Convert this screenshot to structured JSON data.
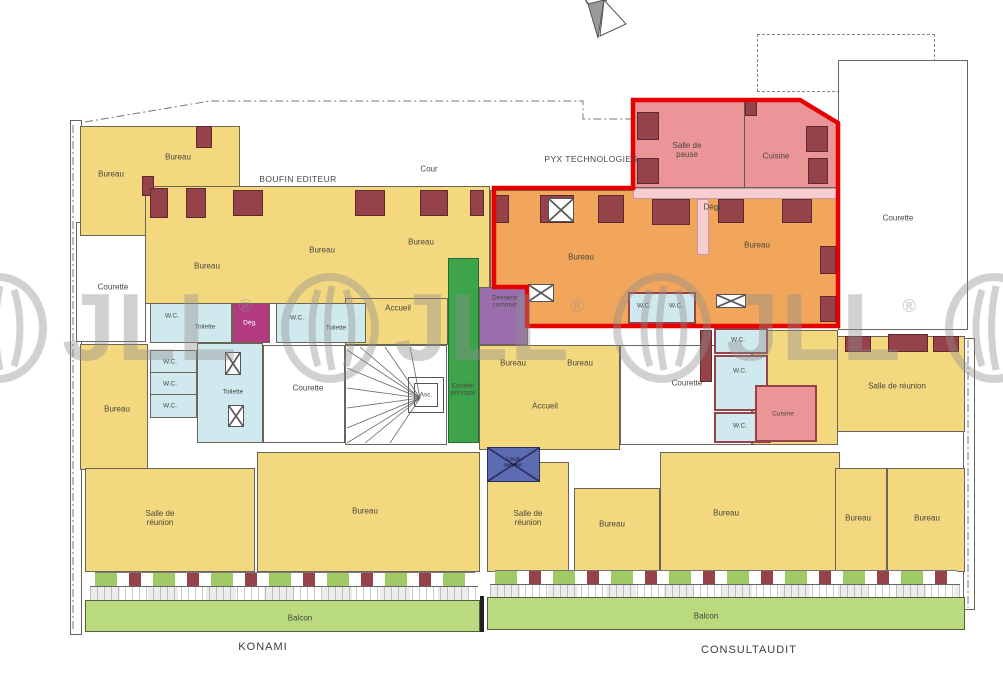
{
  "document": {
    "type": "architectural-floor-plan"
  },
  "companies": {
    "boufin": "BOUFIN EDITEUR",
    "pyx": "PYX TECHNOLOGIES",
    "konami": "KONAMI",
    "consultaudit": "CONSULTAUDIT"
  },
  "rooms": {
    "bureau": "Bureau",
    "cour": "Cour",
    "courette": "Courette",
    "salle_de_pause": "Salle de pause",
    "cuisine": "Cuisine",
    "deg": "Dég.",
    "degt": "Dégt.",
    "toilette": "Toilette",
    "wc": "W.C.",
    "accueil": "Accueil",
    "desserte": "Desserte commun",
    "escalier": "Escalier principal",
    "ascenseur": "Asc.",
    "salle_de_reunion": "Salle de réunion",
    "local_serveur": "Local serveur",
    "balcon": "Balcon"
  },
  "watermark": {
    "brand": "JLL",
    "registered": "®"
  },
  "colors": {
    "lot_outline_red": "#e60000",
    "office_yellow": "#f4d87f",
    "lot_orange": "#f1a65c",
    "lot_pink": "#ec9599",
    "sanitary_blue": "#cfe9ee",
    "circulation_green": "#3da44b",
    "desserte_purple": "#9b6fae",
    "degagement_magenta": "#b23a7f",
    "server_navy": "#5c6cb2",
    "balcony_green": "#b9da7e",
    "wall_pier_maroon": "#95424a",
    "watermark_grey": "#8f8f8f"
  }
}
